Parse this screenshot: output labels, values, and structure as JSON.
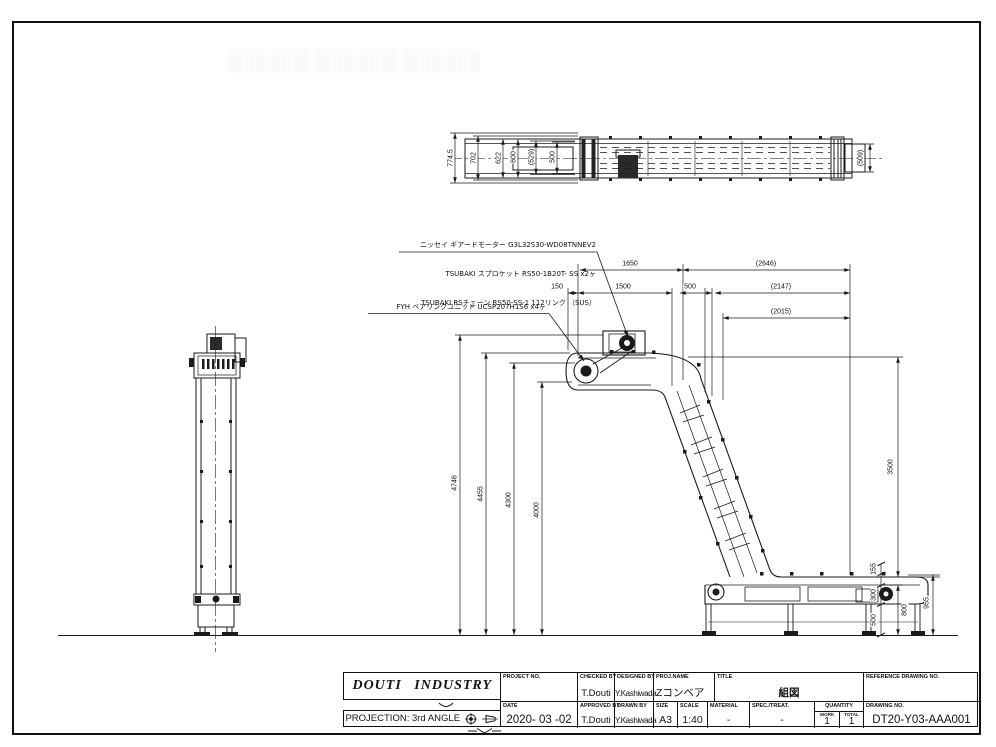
{
  "plan_dims": {
    "overall_width": "774.5",
    "w702": "702",
    "w622": "622",
    "w600": "600",
    "w529": "(529)",
    "w500": "500",
    "w509": "(509)"
  },
  "elev_dims": {
    "l1650": "1650",
    "l2646": "(2646)",
    "l150": "150",
    "l1500": "1500",
    "l500": "500",
    "l2147": "(2147)",
    "l2015": "(2015)",
    "h4746": "4746",
    "h4455": "4455",
    "h4300": "4300",
    "h4000": "4000",
    "h3500": "3500",
    "h155": "155",
    "h300": "300",
    "h500": "500",
    "h800": "800",
    "h955": "955"
  },
  "notes": {
    "line1": "ニッセイ ギアードモーター G3L32S30-WD08TNNEV2",
    "line2": "TSUBAKI スプロケット RS50-1B20T- SS x2ヶ",
    "line3": "TSUBAKI RSチェーン RS50-SS-1 112リンク （SUS）",
    "line4": "FYH ベアリングユニット UCSP207H1S6 x4ヶ"
  },
  "title_block": {
    "company": "DOUTI INDUSTRY",
    "projection_label": "PROJECTION: 3rd ANGLE",
    "project_no_label": "PROJECT NO.",
    "project_no": "",
    "date_label": "DATE",
    "date": "2020- 03 -02",
    "checked_by_label": "CHECKED BY",
    "checked_by": "T.Douti",
    "approved_by_label": "APPROVED BY",
    "approved_by": "T.Douti",
    "designed_by_label": "DESIGNED BY",
    "designed_by": "Y.Kashiwada",
    "drawn_by_label": "DRAWN BY",
    "drawn_by": "Y.Kashiwada",
    "proj_name_label": "PROJ.NAME",
    "proj_name": "Zコンベア",
    "title_label": "TITLE",
    "title": "組図",
    "size_label": "SIZE",
    "size": "A3",
    "scale_label": "SCALE",
    "scale": "1:40",
    "material_label": "MATERIAL",
    "material": "-",
    "spec_label": "SPEC./TREAT.",
    "spec": "-",
    "quantity_label": "QUANTITY",
    "work_label": "WORK",
    "work": "1",
    "total_label": "TOTAL",
    "total": "1",
    "ref_drawing_label": "REFERENCE DRAWING NO.",
    "ref_drawing": "",
    "drawing_no_label": "DRAWING NO.",
    "drawing_no": "DT20-Y03-AAA001"
  }
}
